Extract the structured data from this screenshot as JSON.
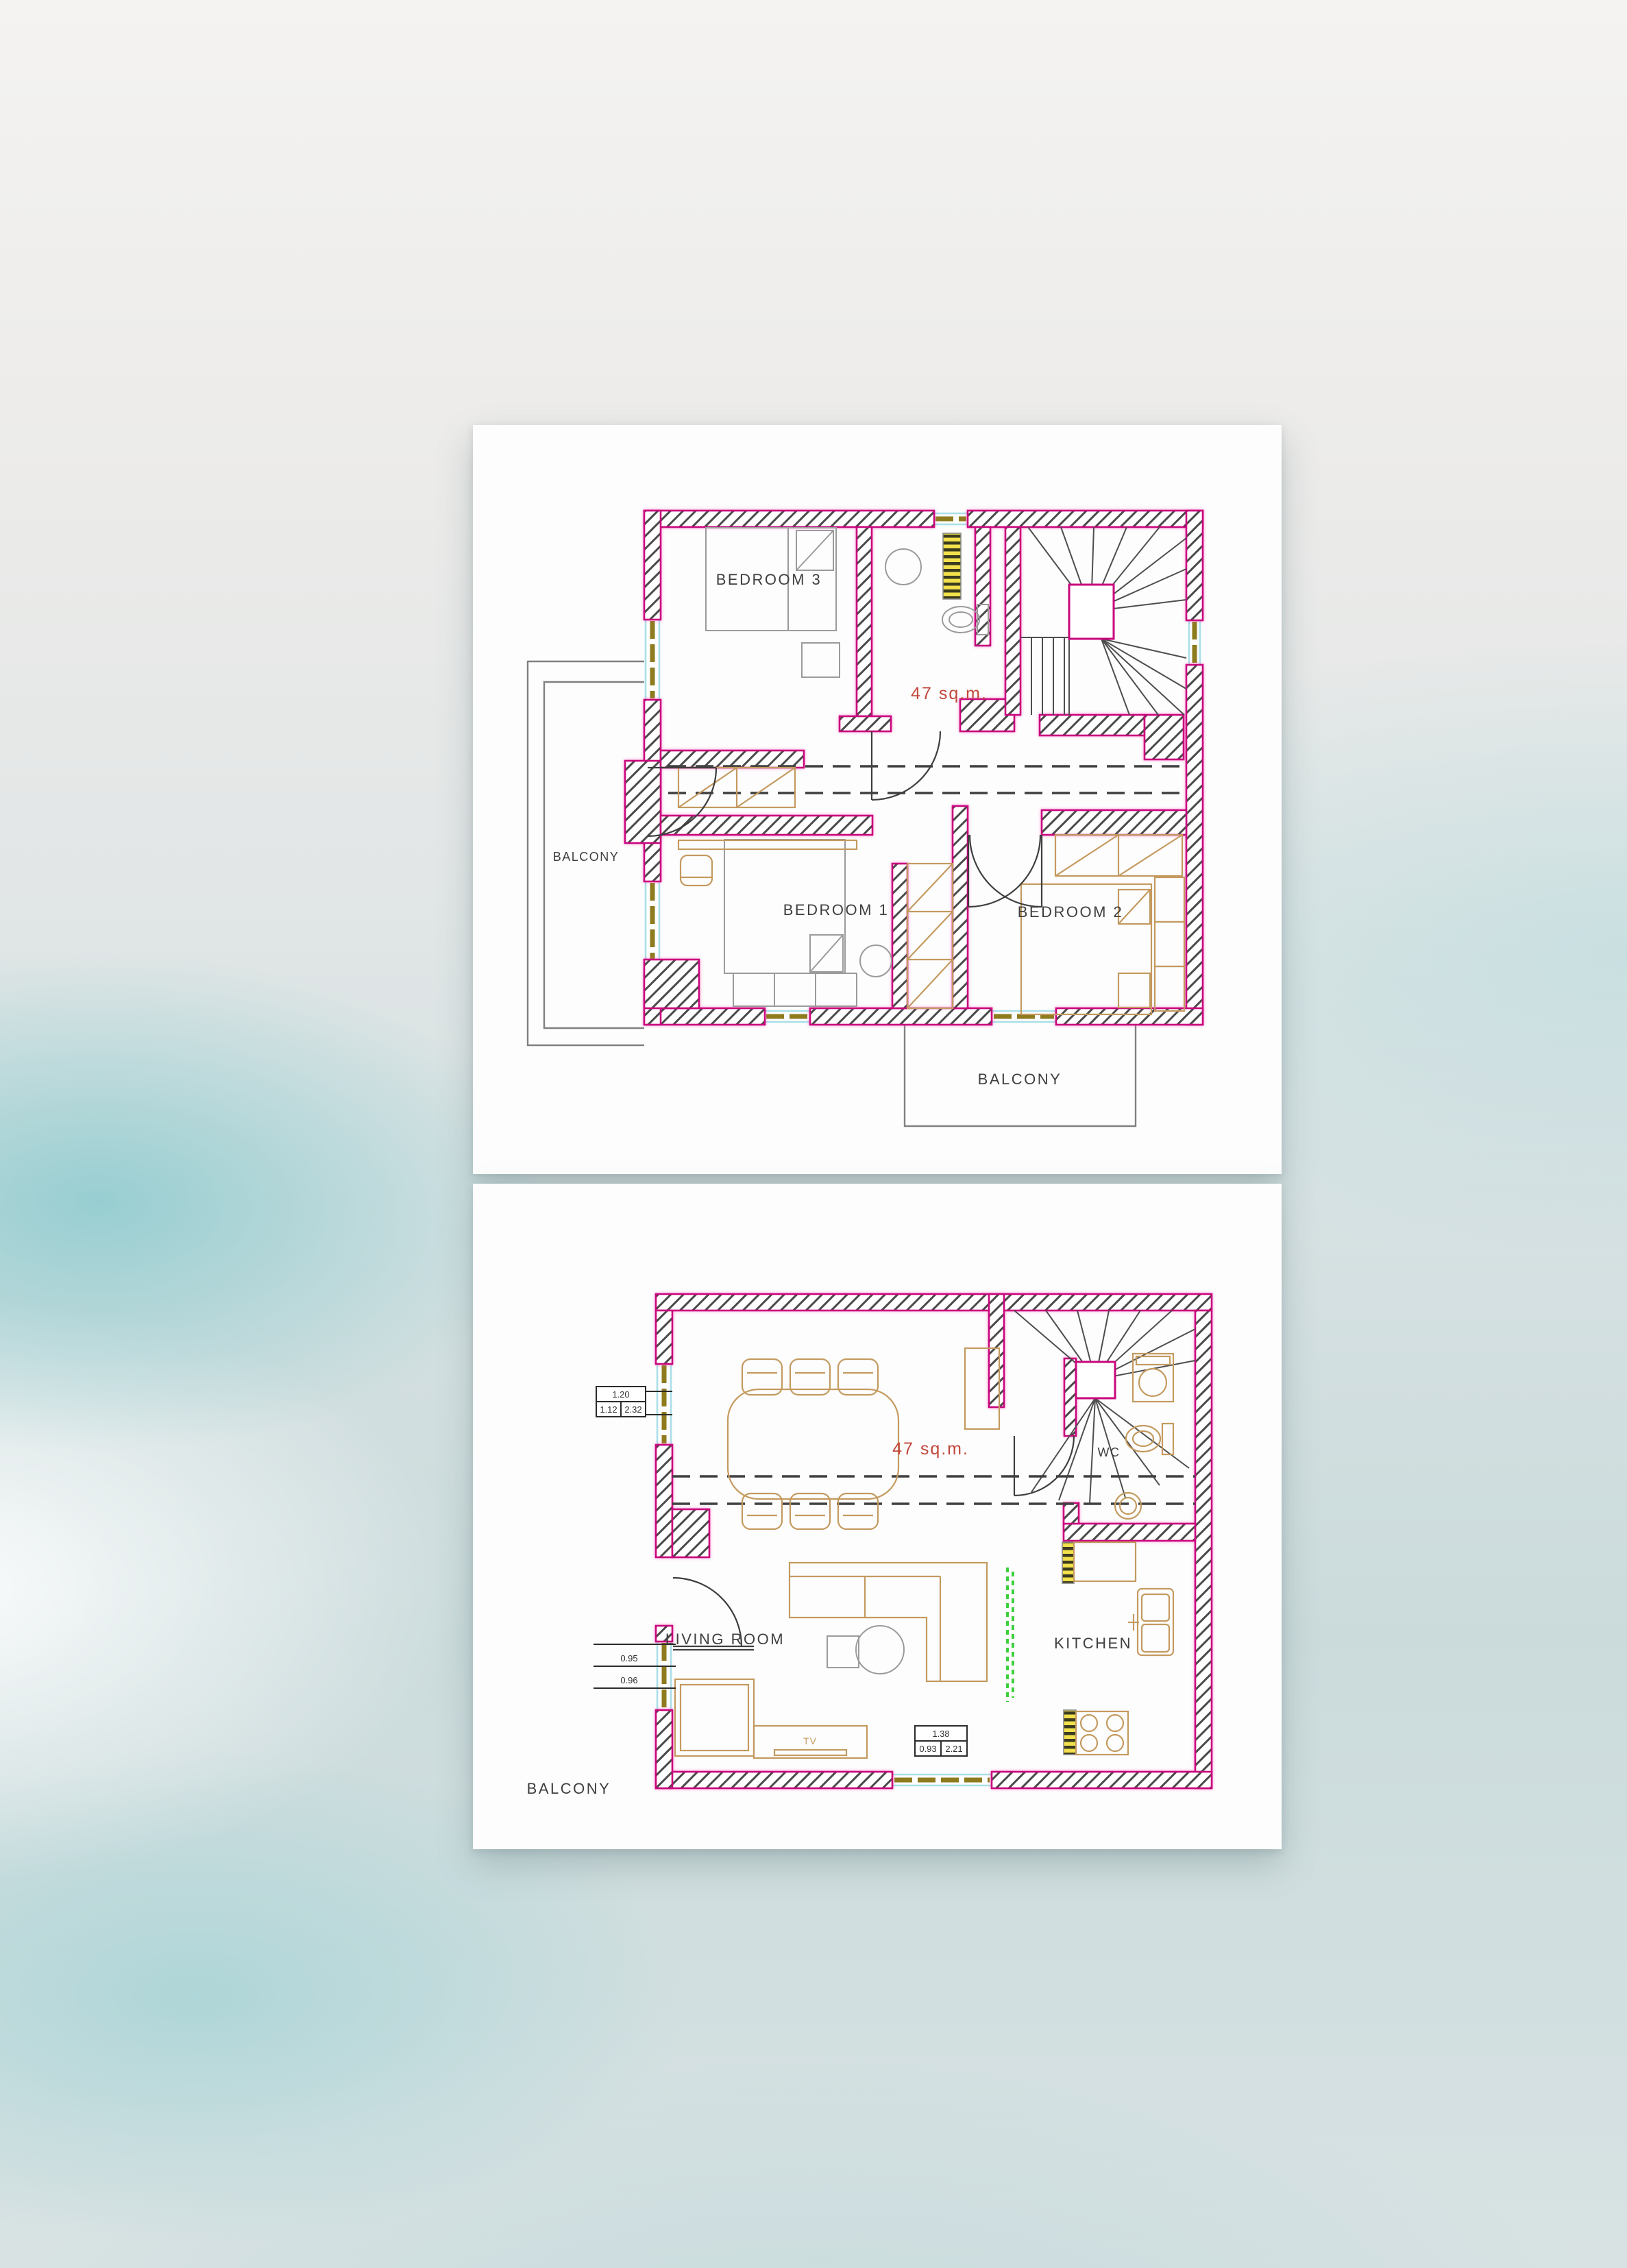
{
  "document": {
    "type": "floor-plan-sheet",
    "floor_count": 2
  },
  "colors": {
    "wall_accent": "#c9067c",
    "wall_hatch": "#4a4a4a",
    "area_text": "#c2473b",
    "window_glass": "#aadfe8",
    "window_frame": "#8d7b1e",
    "warning_stripe_yellow": "#f2e14c",
    "kitchen_strip_green": "#3ecf3e",
    "furniture_tan": "#c49a5f",
    "furniture_gray": "#9b9b9b",
    "card_background": "#fdfdfd"
  },
  "upper": {
    "area": "47 sq.m.",
    "bedroom3": "BEDROOM 3",
    "bedroom1": "BEDROOM 1",
    "bedroom2": "BEDROOM 2",
    "balcony_left": "BALCONY",
    "balcony_bottom": "BALCONY"
  },
  "lower": {
    "area": "47 sq.m.",
    "living_room": "LIVING ROOM",
    "kitchen": "KITCHEN",
    "wc": "WC",
    "balcony": "BALCONY",
    "tv": "TV",
    "dim_window_left_top": {
      "width": "1.20",
      "inner": "1.12",
      "height": "2.32"
    },
    "dim_window_left_bottom": {
      "top": "0.95",
      "bottom": "0.96"
    },
    "dim_window_bottom": {
      "width": "1.38",
      "inner": "0.93",
      "height": "2.21"
    }
  }
}
